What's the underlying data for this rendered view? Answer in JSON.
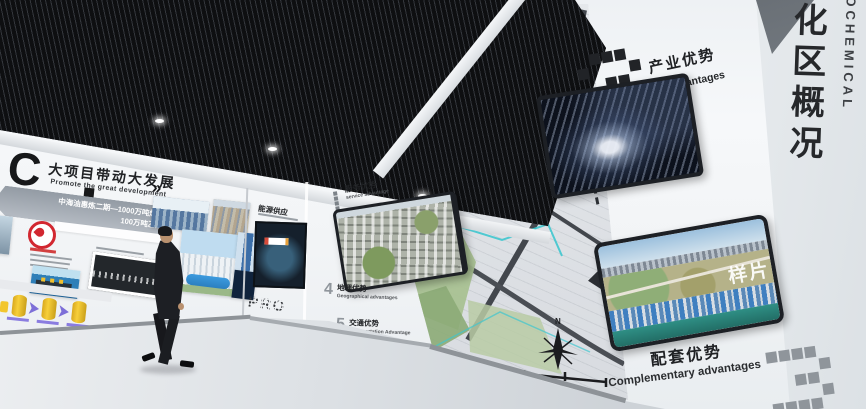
{
  "left_wall": {
    "logo_letter": "C",
    "title_zh": "大项目带动大发展",
    "title_en": "Promote the great development",
    "arrows": "»",
    "banner_line1": "中海油惠炼二期—1000万吨炼油",
    "banner_line2": "100万吨乙烯"
  },
  "advantages": {
    "one": {
      "num": "1",
      "zh": "服务优势",
      "en": "service advantage"
    },
    "two": {
      "num": "2",
      "zh": "产业优势",
      "en": "Industrial advantages"
    },
    "three": {
      "num": "3",
      "zh": "配套优势",
      "en": "Complementary advantages"
    },
    "four": {
      "num": "4",
      "zh": "地理优势",
      "en": "Geographical advantages"
    },
    "five": {
      "num": "5",
      "zh": "交通优势",
      "en": "Transportation Advantage"
    }
  },
  "recess_wall": {
    "title_zh": "能源供应",
    "dotted_text": "PRO"
  },
  "right_wall": {
    "vertical_zh": "化区概况",
    "vertical_en": "ROCHEMICAL"
  },
  "map_mural": {
    "compass_label": "N"
  },
  "screens": {
    "screen_c_watermark": "样片"
  },
  "colors": {
    "ceiling": "#15161a",
    "wall": "#f3f5f7",
    "floor": "#d7dbdf",
    "map_teal": "#3fc6ce",
    "cnooc_red": "#d22730",
    "cylinder_yellow": "#f2c62f",
    "arrow_purple": "#7d6fd8",
    "screen_frame": "#1d2025",
    "text_dark": "#202225"
  }
}
